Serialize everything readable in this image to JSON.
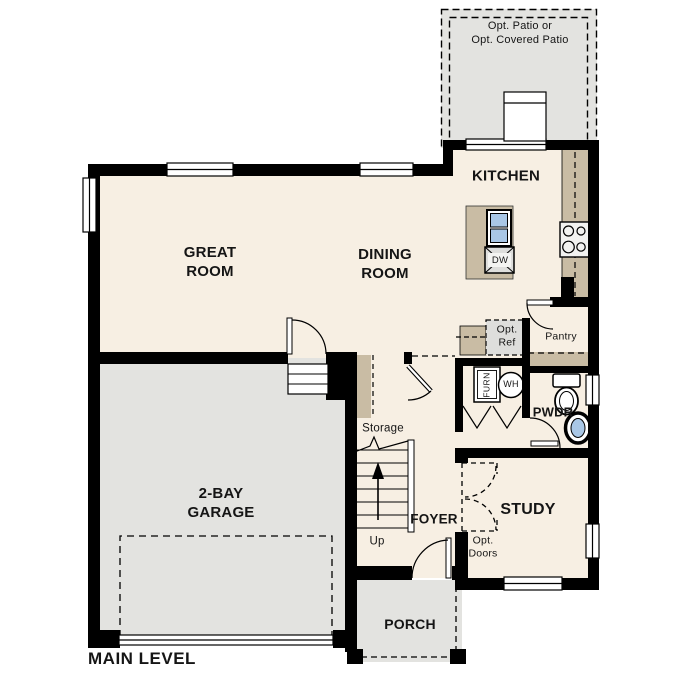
{
  "plan_title": "MAIN LEVEL",
  "labels": {
    "patio": "Opt. Patio or\nOpt. Covered Patio",
    "kitchen": "KITCHEN",
    "great_room": "GREAT\nROOM",
    "dining_room": "DINING\nROOM",
    "garage": "2-BAY\nGARAGE",
    "storage": "Storage",
    "up": "Up",
    "foyer": "FOYER",
    "study": "STUDY",
    "opt_doors": "Opt.\nDoors",
    "opt_ref": "Opt.\nRef",
    "pantry": "Pantry",
    "pwdr": "PWDR",
    "porch": "PORCH",
    "main_level": "MAIN LEVEL",
    "dw": "DW",
    "wh": "WH",
    "furn": "FURN"
  },
  "colors": {
    "floor_cream": "#F7EFE3",
    "concrete_gray": "#E3E3E0",
    "counter_tan": "#C9BCA4",
    "optional_item_gray": "#DEDEDC",
    "fixture_blue": "#A9C7E6",
    "wall_black": "#000000"
  }
}
